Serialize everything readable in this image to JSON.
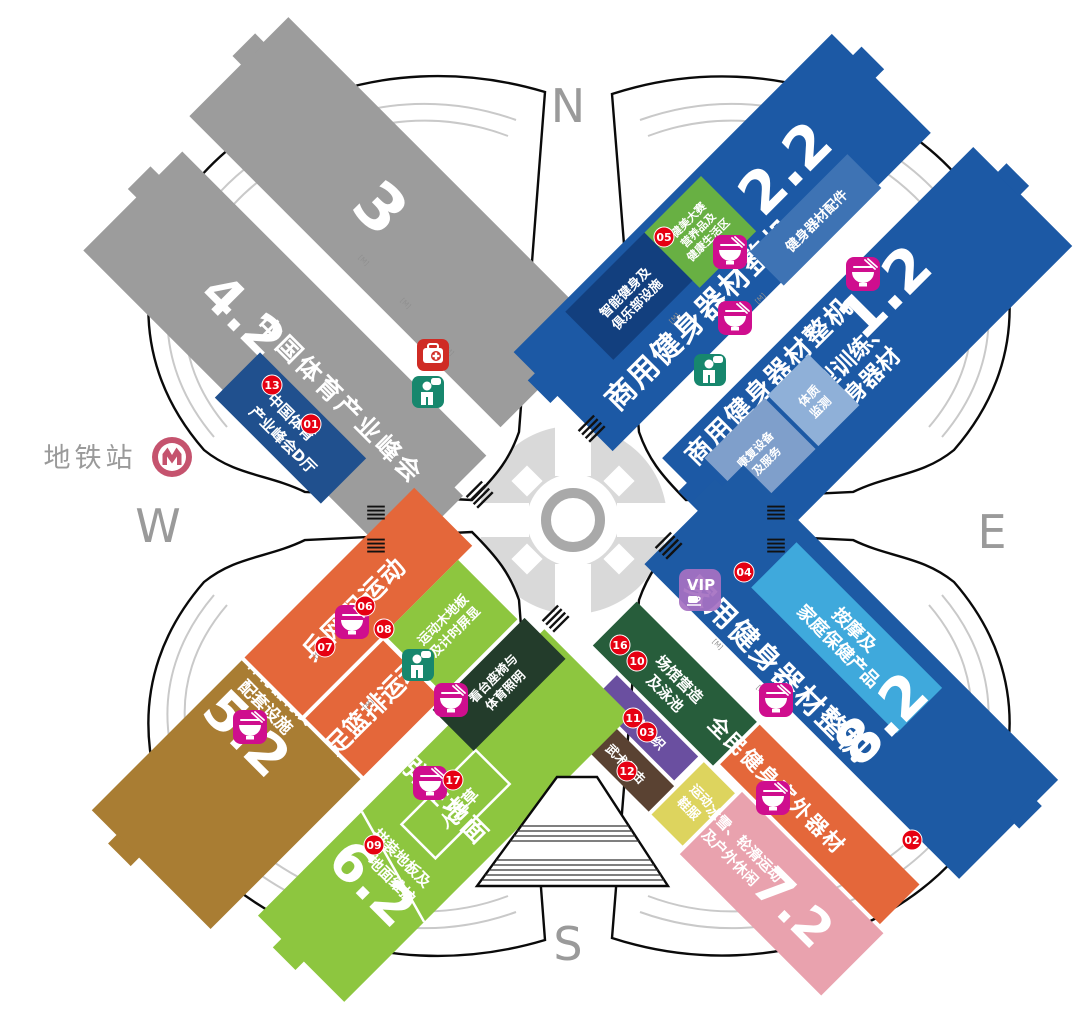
{
  "compass": {
    "n": "N",
    "e": "E",
    "s": "S",
    "w": "W"
  },
  "metro": {
    "label": "地铁站"
  },
  "halls": {
    "h3": "3",
    "h4_2": "4.2",
    "h2_2": "2.2",
    "h1_2": "1.2",
    "h5_2": "5.2",
    "h6_2": "6.2",
    "h7_2": "7.2",
    "h8_2": "8.2"
  },
  "zones": {
    "nw_summit": "中国体育产业峰会",
    "nw_summit_hall_l1": "中国体育",
    "nw_summit_hall_l2": "产业峰会D厅",
    "ne22_main": "商用健身器材整机",
    "ne_bb_l1": "健美大赛",
    "ne_bb_l2": "营养品及",
    "ne_bb_l3": "健康生活区",
    "ne_smart_l1": "智能健身及",
    "ne_smart_l2": "俱乐部设施",
    "ne_parts": "健身器材配件",
    "ne12_main": "商用健身器材整机",
    "ne_small_l1": "小型训练、",
    "ne_small_l2": "健身器材",
    "ne_rehab_l1": "康复设备",
    "ne_rehab_l2": "及服务",
    "ne_test_l1": "体质",
    "ne_test_l2": "监测",
    "se_home": "家用健身器材整机",
    "se_massage_l1": "按摩及",
    "se_massage_l2": "家庭保健产品",
    "se_venue_l1": "场馆营造",
    "se_venue_l2": "及泳池",
    "se_org": "体育组织",
    "se_martial": "武术搏击",
    "se_shoes_l1": "运动",
    "se_shoes_l2": "鞋服",
    "se_outdoor": "全民健身室外器材",
    "se_ice_l1": "冰雪、轮滑运动",
    "se_ice_l2": "及户外休闲",
    "sw_equip_l1": "体育器材及",
    "sw_equip_l2": "配套设施",
    "sw_pp": "乒网羽运动",
    "sw_ball": "足篮排运动",
    "sw_wood_l1": "运动木地板",
    "sw_wood_l2": "及计时屏显",
    "sw_seat_l1": "看台座椅与",
    "sw_seat_l2": "体育照明",
    "sw_elastic": "弹性地面",
    "sw_grass": "人造草",
    "sw_floor_l1": "拼装地板及",
    "sw_floor_l2": "地面维护"
  },
  "markers": {
    "m01": "01",
    "m02": "02",
    "m03": "03",
    "m04": "04",
    "m05": "05",
    "m06": "06",
    "m07": "07",
    "m08": "08",
    "m09": "09",
    "m10": "10",
    "m11": "11",
    "m12": "12",
    "m13": "13",
    "m16": "16",
    "m17": "17"
  },
  "vip_label": "VIP",
  "edge_mark": "[M]",
  "colors": {
    "hall_gray": "#9c9c9c",
    "hall_blue": "#1c59a5",
    "summit_blue": "#20508e",
    "green_zone": "#68b043",
    "dark_blue_zone": "#123f7e",
    "parts_blue": "#3e73b4",
    "rehab_blue": "#7f9fcb",
    "test_blue": "#8fb0d8",
    "massage_blue": "#3fa9dc",
    "brown_hall": "#a97d33",
    "lime_hall": "#8dc63f",
    "orange_zone": "#e4673a",
    "dark_green_zone": "#275d3b",
    "purple_zone": "#6a4fa0",
    "dark_brown_zone": "#5a4232",
    "yellow_zone": "#ddd45e",
    "pink_zone": "#e9a2ae",
    "seat_zone": "#233c2b",
    "marker_red": "#e60012",
    "restaurant_magenta": "#cf0e8e",
    "restroom_teal": "#17876d",
    "first_aid_red": "#cf2b24",
    "vip_purple": "#a671c2",
    "metro_pink": "#c5536e"
  }
}
